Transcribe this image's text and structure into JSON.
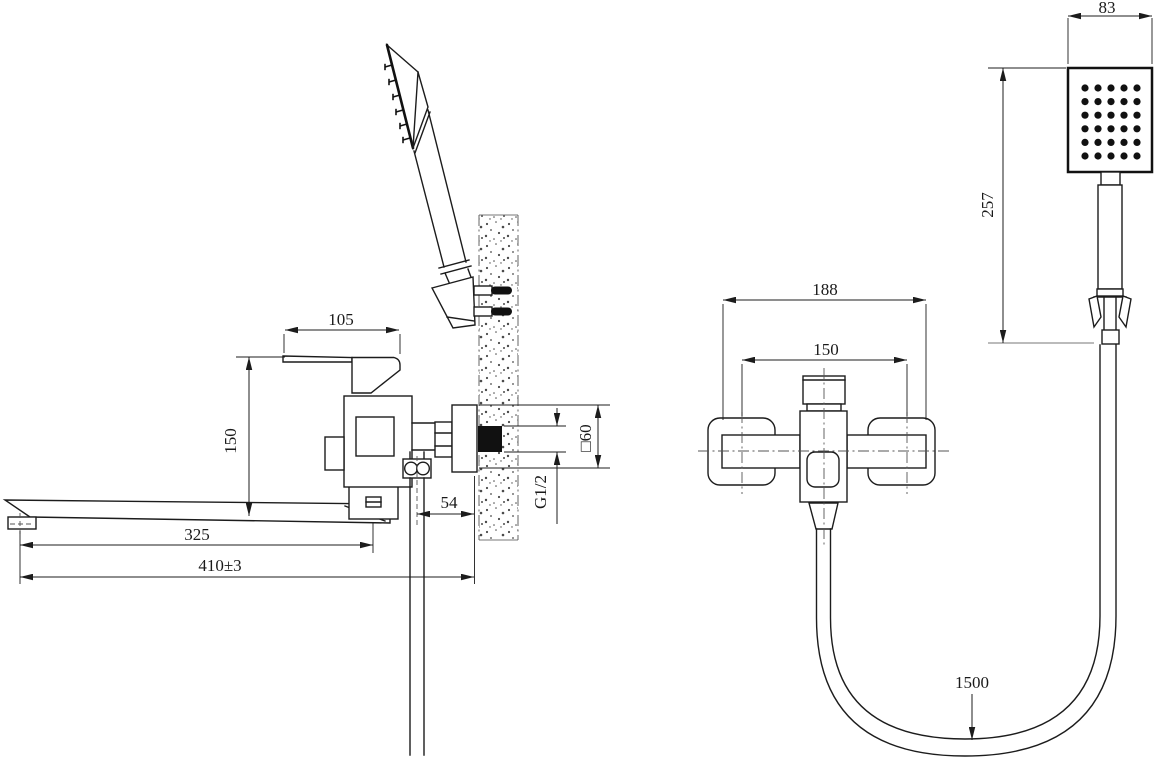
{
  "drawing": {
    "description": "Technical dimension drawing of wall-mounted bath mixer with long spout and handheld square shower",
    "background_color": "#ffffff",
    "line_color": "#1c1c1c",
    "dims": {
      "d105": "105",
      "d150_side": "150",
      "d325": "325",
      "d410": "410±3",
      "d54": "54",
      "g12": "G1/2",
      "sq60": "□60",
      "d188": "188",
      "d150_front": "150",
      "d83": "83",
      "d257": "257",
      "d1500": "1500"
    }
  }
}
